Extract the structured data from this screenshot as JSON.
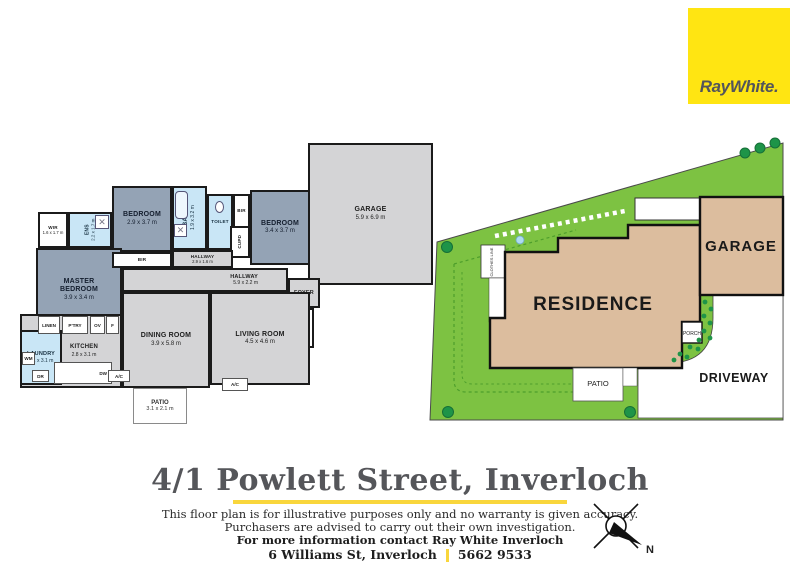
{
  "logo": {
    "brand": "RayWhite."
  },
  "floorplan": {
    "rooms": {
      "wir": {
        "name": "WIR",
        "dims": "1.6 x 1.7 m"
      },
      "ens": {
        "name": "ENS",
        "dims": "2.2 x 1.7 m"
      },
      "master": {
        "name": "MASTER BEDROOM",
        "dims": "3.9 x 3.4 m"
      },
      "bedroom1": {
        "name": "BEDROOM",
        "dims": "2.9 x 3.7 m"
      },
      "bath": {
        "name": "BATH",
        "dims": "1.9 x 3.2 m"
      },
      "toilet": {
        "name": "TOILET"
      },
      "bedroom2": {
        "name": "BEDROOM",
        "dims": "3.4 x 3.7 m"
      },
      "garage": {
        "name": "GARAGE",
        "dims": "5.9 x 6.9 m"
      },
      "hallway1": {
        "name": "HALLWAY",
        "dims": "2.9 x 1.6 m"
      },
      "hallway2": {
        "name": "HALLWAY",
        "dims": "5.9 x 2.2 m"
      },
      "foyer": {
        "name": "FOYER"
      },
      "porch": {
        "name": "PORCH",
        "dims": "1.4 x 2.0 m"
      },
      "dining": {
        "name": "DINING ROOM",
        "dims": "3.9 x 5.8 m"
      },
      "living": {
        "name": "LIVING ROOM",
        "dims": "4.5 x 4.6 m"
      },
      "kitchen": {
        "name": "KITCHEN",
        "dims": "2.8 x 3.1 m"
      },
      "laundry": {
        "name": "LAUNDRY",
        "dims": "2.1 x 3.1 m"
      },
      "patio": {
        "name": "PATIO",
        "dims": "3.1 x 2.1 m"
      }
    },
    "fixtures": {
      "bir": "BIR",
      "cupd": "CUPD",
      "linen": "LINEN",
      "pantry": "P'TRY",
      "oven": "OV",
      "fridge": "F",
      "wm": "WM",
      "dryer": "DR",
      "dw": "DW",
      "ac": "A/C"
    }
  },
  "siteplan": {
    "residence": "RESIDENCE",
    "garage": "GARAGE",
    "driveway": "DRIVEWAY",
    "patio": "PATIO",
    "porch": "PORCH",
    "clothes_line": "CLOTHES LINE"
  },
  "footer": {
    "address": "4/1 Powlett Street, Inverloch",
    "disclaimer1": "This floor plan is for illustrative purposes only and no warranty is given accuracy.",
    "disclaimer2": "Purchasers are advised to carry out their own investigation.",
    "contact": "For more information contact Ray White Inverloch",
    "office": "6 Williams St, Inverloch",
    "phone": "5662 9533",
    "compass": "N"
  },
  "colors": {
    "brand_yellow": "#FFE512",
    "accent_yellow": "#F9D63C",
    "lawn_green": "#7DC242",
    "tree_green": "#1E9448",
    "building_tan": "#DCBD9E",
    "room_blue_gray": "#94A3B5",
    "wet_area_blue": "#C9E6F6",
    "room_gray": "#D4D4D6",
    "title_gray": "#55565A"
  }
}
